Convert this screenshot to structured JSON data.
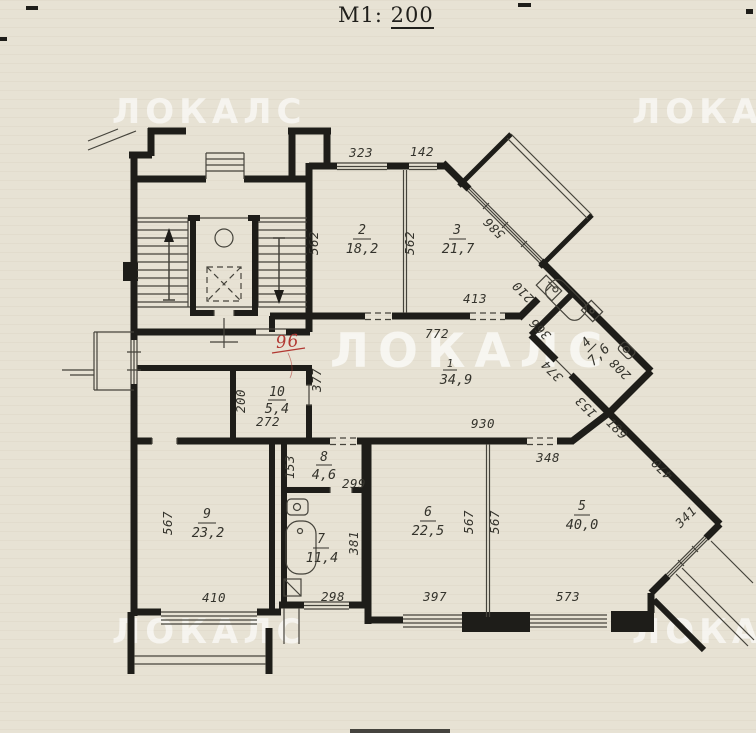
{
  "title": {
    "label": "М1:",
    "scale": "200"
  },
  "watermark": {
    "text": "ЛОКАЛС"
  },
  "plan": {
    "rooms": {
      "r1": {
        "num": "1",
        "area": "34,9"
      },
      "r2": {
        "num": "2",
        "area": "18,2"
      },
      "r3": {
        "num": "3",
        "area": "21,7"
      },
      "r4": {
        "num": "4",
        "area": "7,6"
      },
      "r5": {
        "num": "5",
        "area": "40,0"
      },
      "r6": {
        "num": "6",
        "area": "22,5"
      },
      "r7": {
        "num": "7",
        "area": "11,4"
      },
      "r8": {
        "num": "8",
        "area": "4,6"
      },
      "r9": {
        "num": "9",
        "area": "23,2"
      },
      "r10": {
        "num": "10",
        "area": "5,4"
      }
    },
    "dims": {
      "top_323": "323",
      "top_142": "142",
      "left_562": "562",
      "mid_562": "562",
      "diag_586": "586",
      "room3_413": "413",
      "vent_210": "210",
      "hall_772": "772",
      "hall_930": "930",
      "hall_377": "377",
      "diag_366": "366",
      "diag_374": "374",
      "room4_153": "153",
      "room4_208": "208",
      "room5_348": "348",
      "door_189": "189",
      "diag_470": "470",
      "win_341": "341",
      "room10_200": "200",
      "room10_272": "272",
      "room8_153": "153",
      "room8_299": "299",
      "room9_567": "567",
      "room9_410": "410",
      "room7_381": "381",
      "room7_298": "298",
      "room6_397": "397",
      "room6_567": "567",
      "room5_567": "567",
      "room5_573": "573"
    },
    "handwritten": {
      "apartment_number": "96"
    }
  }
}
